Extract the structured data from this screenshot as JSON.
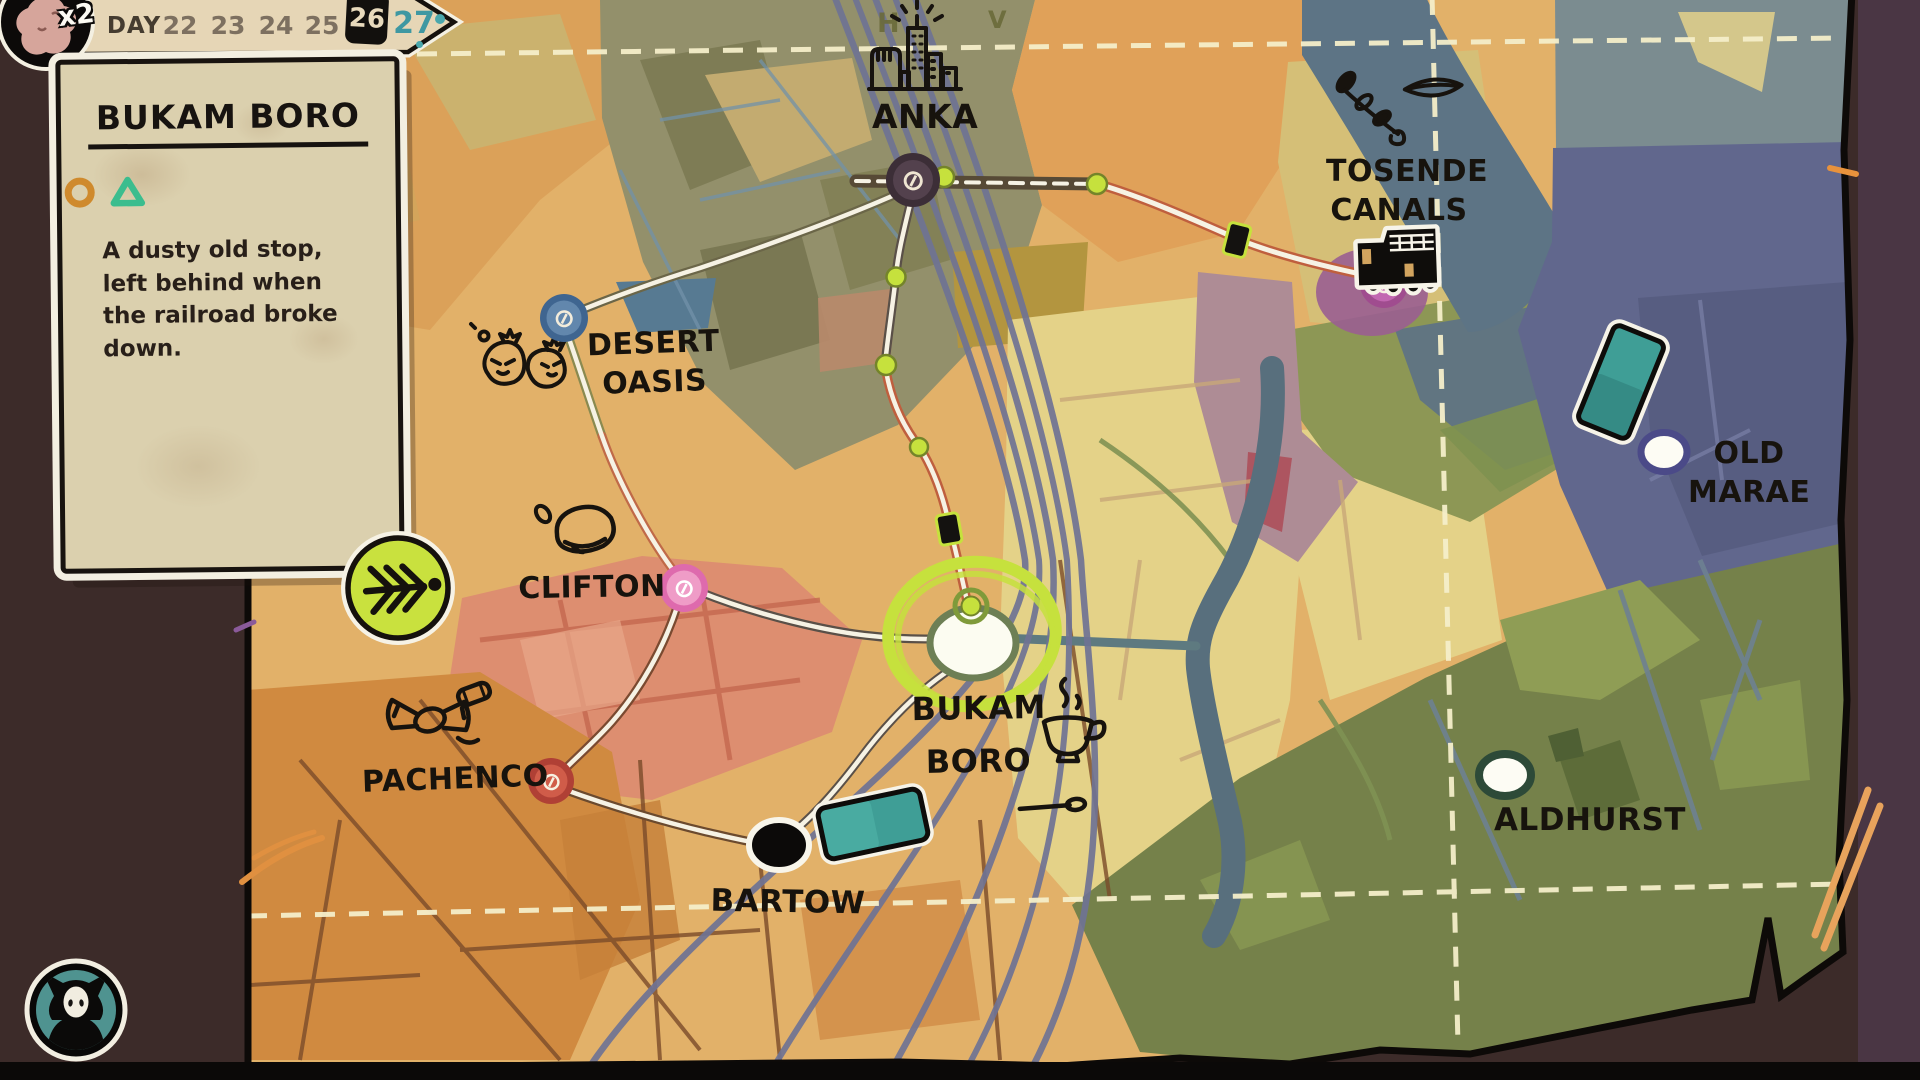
{
  "hud": {
    "day_label": "DAY",
    "days": [
      "22",
      "23",
      "24",
      "25",
      "26",
      "27"
    ],
    "boxed_day": "26",
    "highlighted_day": "27",
    "player_badge": "x2"
  },
  "info_card": {
    "title": "BUKAM BORO",
    "description": "A dusty old stop, left behind when the railroad broke down.",
    "tag_icons": [
      "orange-circle",
      "teal-triangle"
    ]
  },
  "map": {
    "node_glyph": "⊘",
    "letters": {
      "h": "H",
      "v": "V"
    },
    "locations": [
      {
        "name": "ANKA",
        "type": "station"
      },
      {
        "name": "DESERT OASIS",
        "type": "station"
      },
      {
        "name": "CLIFTON",
        "type": "station"
      },
      {
        "name": "PACHENCO",
        "type": "station"
      },
      {
        "name": "BARTOW",
        "type": "town"
      },
      {
        "name": "BUKAM BORO",
        "type": "current-location"
      },
      {
        "name": "TOSENDE CANALS",
        "type": "station"
      },
      {
        "name": "OLD MARAE",
        "type": "town"
      },
      {
        "name": "ALDHURST",
        "type": "town"
      }
    ],
    "doodle_icons": [
      "city-icon",
      "money-bags-icon",
      "rock-icon",
      "candy-icon",
      "coffee-cup-icon",
      "leaves-icon",
      "truck-icon",
      "ticket-icon"
    ]
  },
  "colors": {
    "highlight_lime": "#c6e13d",
    "day_highlight_teal": "#3f98a2",
    "tag_circle_orange": "#cf8a2d",
    "tag_triangle_teal": "#3bbd8e",
    "parchment": "#dbd0ae"
  }
}
